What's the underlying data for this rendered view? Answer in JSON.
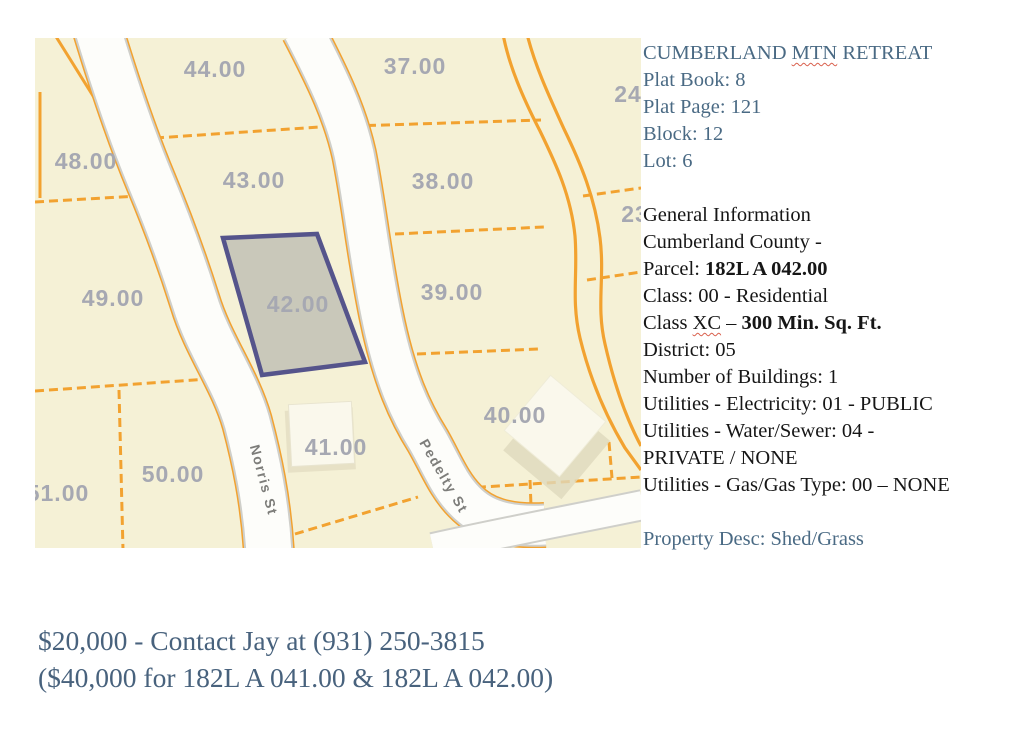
{
  "colors": {
    "info_blue": "#4a6a84",
    "info_black": "#161616",
    "footer_blue": "#48627d",
    "squiggle_red": "#d9604d",
    "map_parcel_fill": "#f5f1d6",
    "map_line_orange": "#f2a230",
    "map_street_fill": "#fdfdfa",
    "map_street_casing": "#cfcfca",
    "map_parcel_label": "#a6a8b2",
    "map_street_label": "#7d7d7a",
    "map_highlight_fill": "#c9c8ba",
    "map_highlight_border": "#55548b",
    "map_building_fill": "#faf8ec",
    "map_building_shadow": "#ded9bd"
  },
  "map": {
    "parcel_labels": [
      {
        "text": "44.00",
        "x": 180,
        "y": 31
      },
      {
        "text": "37.00",
        "x": 380,
        "y": 28
      },
      {
        "text": "24",
        "x": 593,
        "y": 56
      },
      {
        "text": "48.00",
        "x": 51,
        "y": 123
      },
      {
        "text": "43.00",
        "x": 219,
        "y": 142
      },
      {
        "text": "38.00",
        "x": 408,
        "y": 143
      },
      {
        "text": "23",
        "x": 600,
        "y": 176
      },
      {
        "text": "49.00",
        "x": 78,
        "y": 260
      },
      {
        "text": "42.00",
        "x": 263,
        "y": 266
      },
      {
        "text": "39.00",
        "x": 417,
        "y": 254
      },
      {
        "text": "40.00",
        "x": 480,
        "y": 377
      },
      {
        "text": "41.00",
        "x": 301,
        "y": 409
      },
      {
        "text": "50.00",
        "x": 138,
        "y": 436
      },
      {
        "text": "51.00",
        "x": 23,
        "y": 455
      }
    ],
    "street_labels": [
      {
        "text": "Norris St",
        "x": 229,
        "y": 442,
        "rotate": 75
      },
      {
        "text": "Pedelty St",
        "x": 409,
        "y": 438,
        "rotate": 60
      }
    ],
    "highlighted_parcel": "42.00"
  },
  "info_panel": {
    "lines": [
      {
        "color": "blue",
        "segments": [
          {
            "t": "CUMBERLAND "
          },
          {
            "t": "MTN",
            "misspelled": true
          },
          {
            "t": " RETREAT"
          }
        ]
      },
      {
        "color": "blue",
        "segments": [
          {
            "t": "Plat Book: 8"
          }
        ]
      },
      {
        "color": "blue",
        "segments": [
          {
            "t": "Plat Page: 121"
          }
        ]
      },
      {
        "color": "blue",
        "segments": [
          {
            "t": "Block: 12"
          }
        ]
      },
      {
        "color": "blue",
        "segments": [
          {
            "t": "Lot: 6"
          }
        ]
      },
      {
        "blank": true
      },
      {
        "color": "black",
        "segments": [
          {
            "t": "General Information"
          }
        ]
      },
      {
        "color": "black",
        "segments": [
          {
            "t": "Cumberland County -"
          }
        ]
      },
      {
        "color": "black",
        "segments": [
          {
            "t": "Parcel: "
          },
          {
            "t": "182L A 042.00",
            "bold": true
          }
        ]
      },
      {
        "color": "black",
        "segments": [
          {
            "t": "Class: 00 - Residential"
          }
        ]
      },
      {
        "color": "black",
        "segments": [
          {
            "t": "Class "
          },
          {
            "t": "XC",
            "misspelled": true
          },
          {
            "t": " – "
          },
          {
            "t": "300 Min. Sq. Ft.",
            "bold": true
          }
        ]
      },
      {
        "color": "black",
        "segments": [
          {
            "t": "District: 05"
          }
        ]
      },
      {
        "color": "black",
        "segments": [
          {
            "t": "Number of Buildings: 1"
          }
        ]
      },
      {
        "color": "black",
        "segments": [
          {
            "t": "Utilities - Electricity: 01 - PUBLIC"
          }
        ]
      },
      {
        "color": "black",
        "segments": [
          {
            "t": "Utilities - Water/Sewer: 04 -"
          }
        ]
      },
      {
        "color": "black",
        "segments": [
          {
            "t": "PRIVATE / NONE"
          }
        ]
      },
      {
        "color": "black",
        "segments": [
          {
            "t": "Utilities - Gas/Gas Type: 00 – NONE"
          }
        ]
      },
      {
        "blank": true
      },
      {
        "color": "blue",
        "segments": [
          {
            "t": "Property Desc: Shed/Grass"
          }
        ]
      }
    ]
  },
  "footer": {
    "line1": "$20,000 - Contact Jay at (931) 250-3815",
    "line2": "($40,000 for 182L A 041.00 & 182L A 042.00)"
  }
}
